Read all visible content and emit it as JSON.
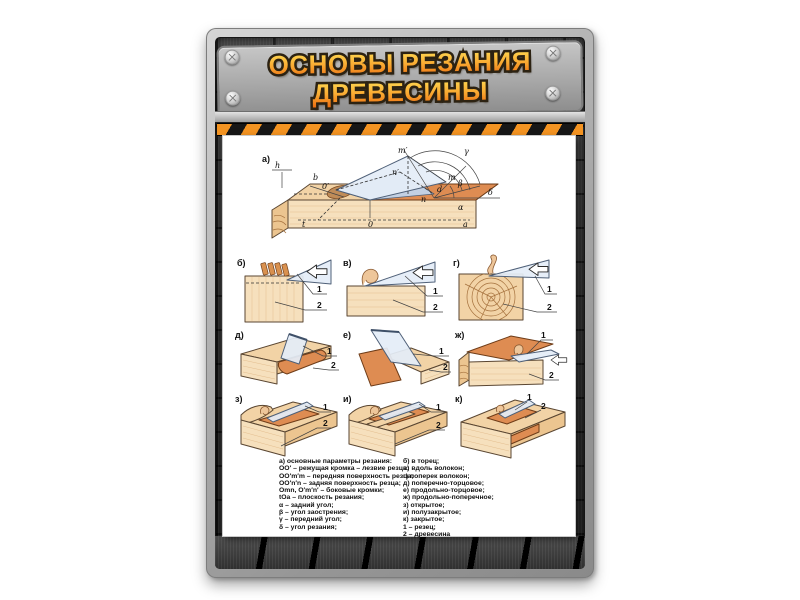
{
  "header": {
    "title_line1": "ОСНОВЫ РЕЗАНИЯ",
    "title_line2": "ДРЕВЕСИНЫ"
  },
  "colors": {
    "title_orange": "#f9a931",
    "hazard_orange": "#f49422",
    "wood_light": "#f2d3a6",
    "cut_orange": "#de8c52",
    "blade_blue": "#e4edf7"
  },
  "figures": {
    "a": {
      "tag": "а)",
      "pts": {
        "h": "h",
        "b": "b",
        "o1": "0′",
        "m1": "m′",
        "n1": "n′",
        "m": "m",
        "d": "d",
        "n": "n",
        "o": "0",
        "a": "a",
        "t": "t",
        "gamma": "γ",
        "beta": "β",
        "delta": "δ",
        "alpha": "α"
      }
    },
    "b": {
      "tag": "б)"
    },
    "v": {
      "tag": "в)"
    },
    "g": {
      "tag": "г)"
    },
    "d": {
      "tag": "д)"
    },
    "e": {
      "tag": "е)"
    },
    "zh": {
      "tag": "ж)"
    },
    "z": {
      "tag": "з)"
    },
    "i": {
      "tag": "и)"
    },
    "k": {
      "tag": "к)"
    },
    "callout1": "1",
    "callout2": "2"
  },
  "legend": {
    "left": [
      "а) основные параметры резания:",
      "ОО′ – режущая кромка – лезвие резца;",
      "ОО′m′m – передняя поверхность резца;",
      "ОО′n′n – задняя поверхность резца;",
      "Оmn, О′m′n′ – боковые кромки;",
      "tОа – плоскость резания;",
      "α – задний угол;",
      "β – угол заострения;",
      "γ – передний угол;",
      "δ – угол резания;"
    ],
    "right": [
      "б) в торец;",
      "в) вдоль волокон;",
      "г) поперек волокон;",
      "д) поперечно-торцовое;",
      "е) продольно-торцовое;",
      "ж) продольно-поперечное;",
      "з) открытое;",
      "и) полузакрытое;",
      "к) закрытое;",
      "1 – резец;",
      "2 – древесина"
    ]
  }
}
